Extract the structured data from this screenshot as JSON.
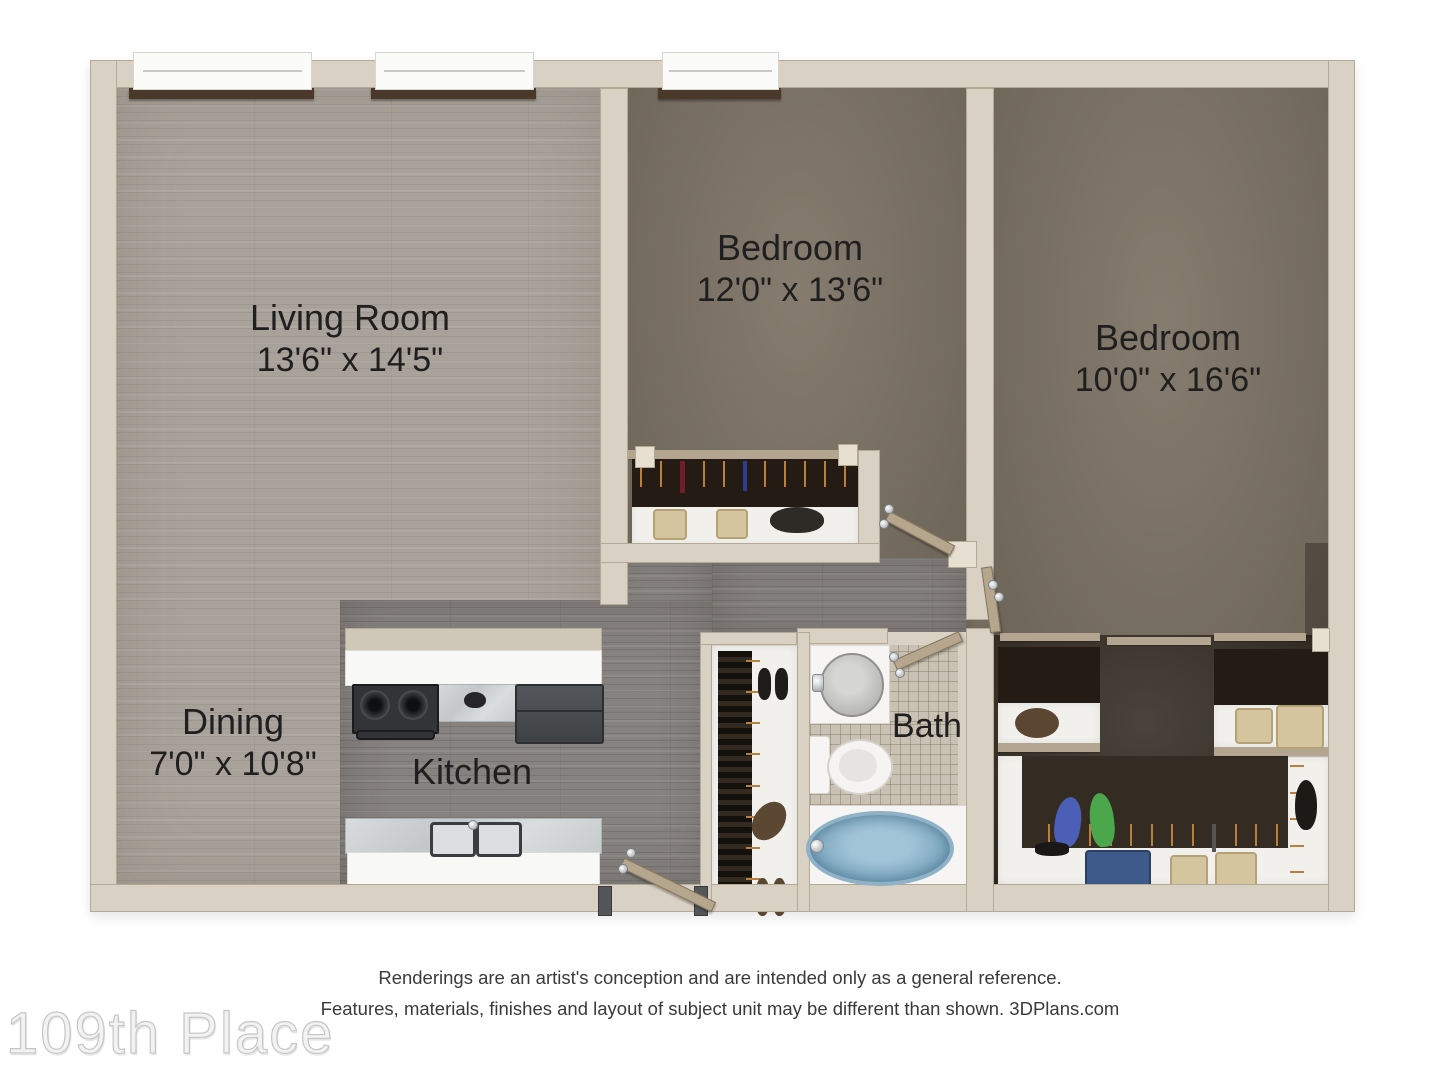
{
  "plan": {
    "rooms": [
      {
        "id": "living_room",
        "label": "Living Room",
        "dimensions": "13'6\" x 14'5\""
      },
      {
        "id": "bedroom_1",
        "label": "Bedroom",
        "dimensions": "12'0\" x 13'6\""
      },
      {
        "id": "bedroom_2",
        "label": "Bedroom",
        "dimensions": "10'0\" x 16'6\""
      },
      {
        "id": "dining",
        "label": "Dining",
        "dimensions": "7'0\" x 10'8\""
      },
      {
        "id": "kitchen",
        "label": "Kitchen",
        "dimensions": ""
      },
      {
        "id": "bath",
        "label": "Bath",
        "dimensions": ""
      }
    ]
  },
  "footer": {
    "disclaimer_line1": "Renderings are an artist's conception and are intended only as a general reference.",
    "disclaimer_line2": "Features, materials, finishes and layout of subject unit may be different than shown. 3DPlans.com",
    "watermark": "109th Place"
  },
  "colors": {
    "wall": "#d9d1c3",
    "wood_light": "#a9a29a",
    "wood_dark": "#868280",
    "carpet": "#7e7466",
    "carpet_dark": "#3b332a",
    "closet_shelf_dark": "#241c14",
    "tan_trim": "#b3a58f",
    "tile": "#c9c1b3",
    "tub_blue": "#7fa9c2",
    "door_leaf": "#b5a68d",
    "window_sill": "#4a392b",
    "hanger": "#b97f3e",
    "basket_beige": "#d5c59e",
    "label_dark": "#1f1f1f",
    "watermark_gray": "#f2f2f2"
  }
}
